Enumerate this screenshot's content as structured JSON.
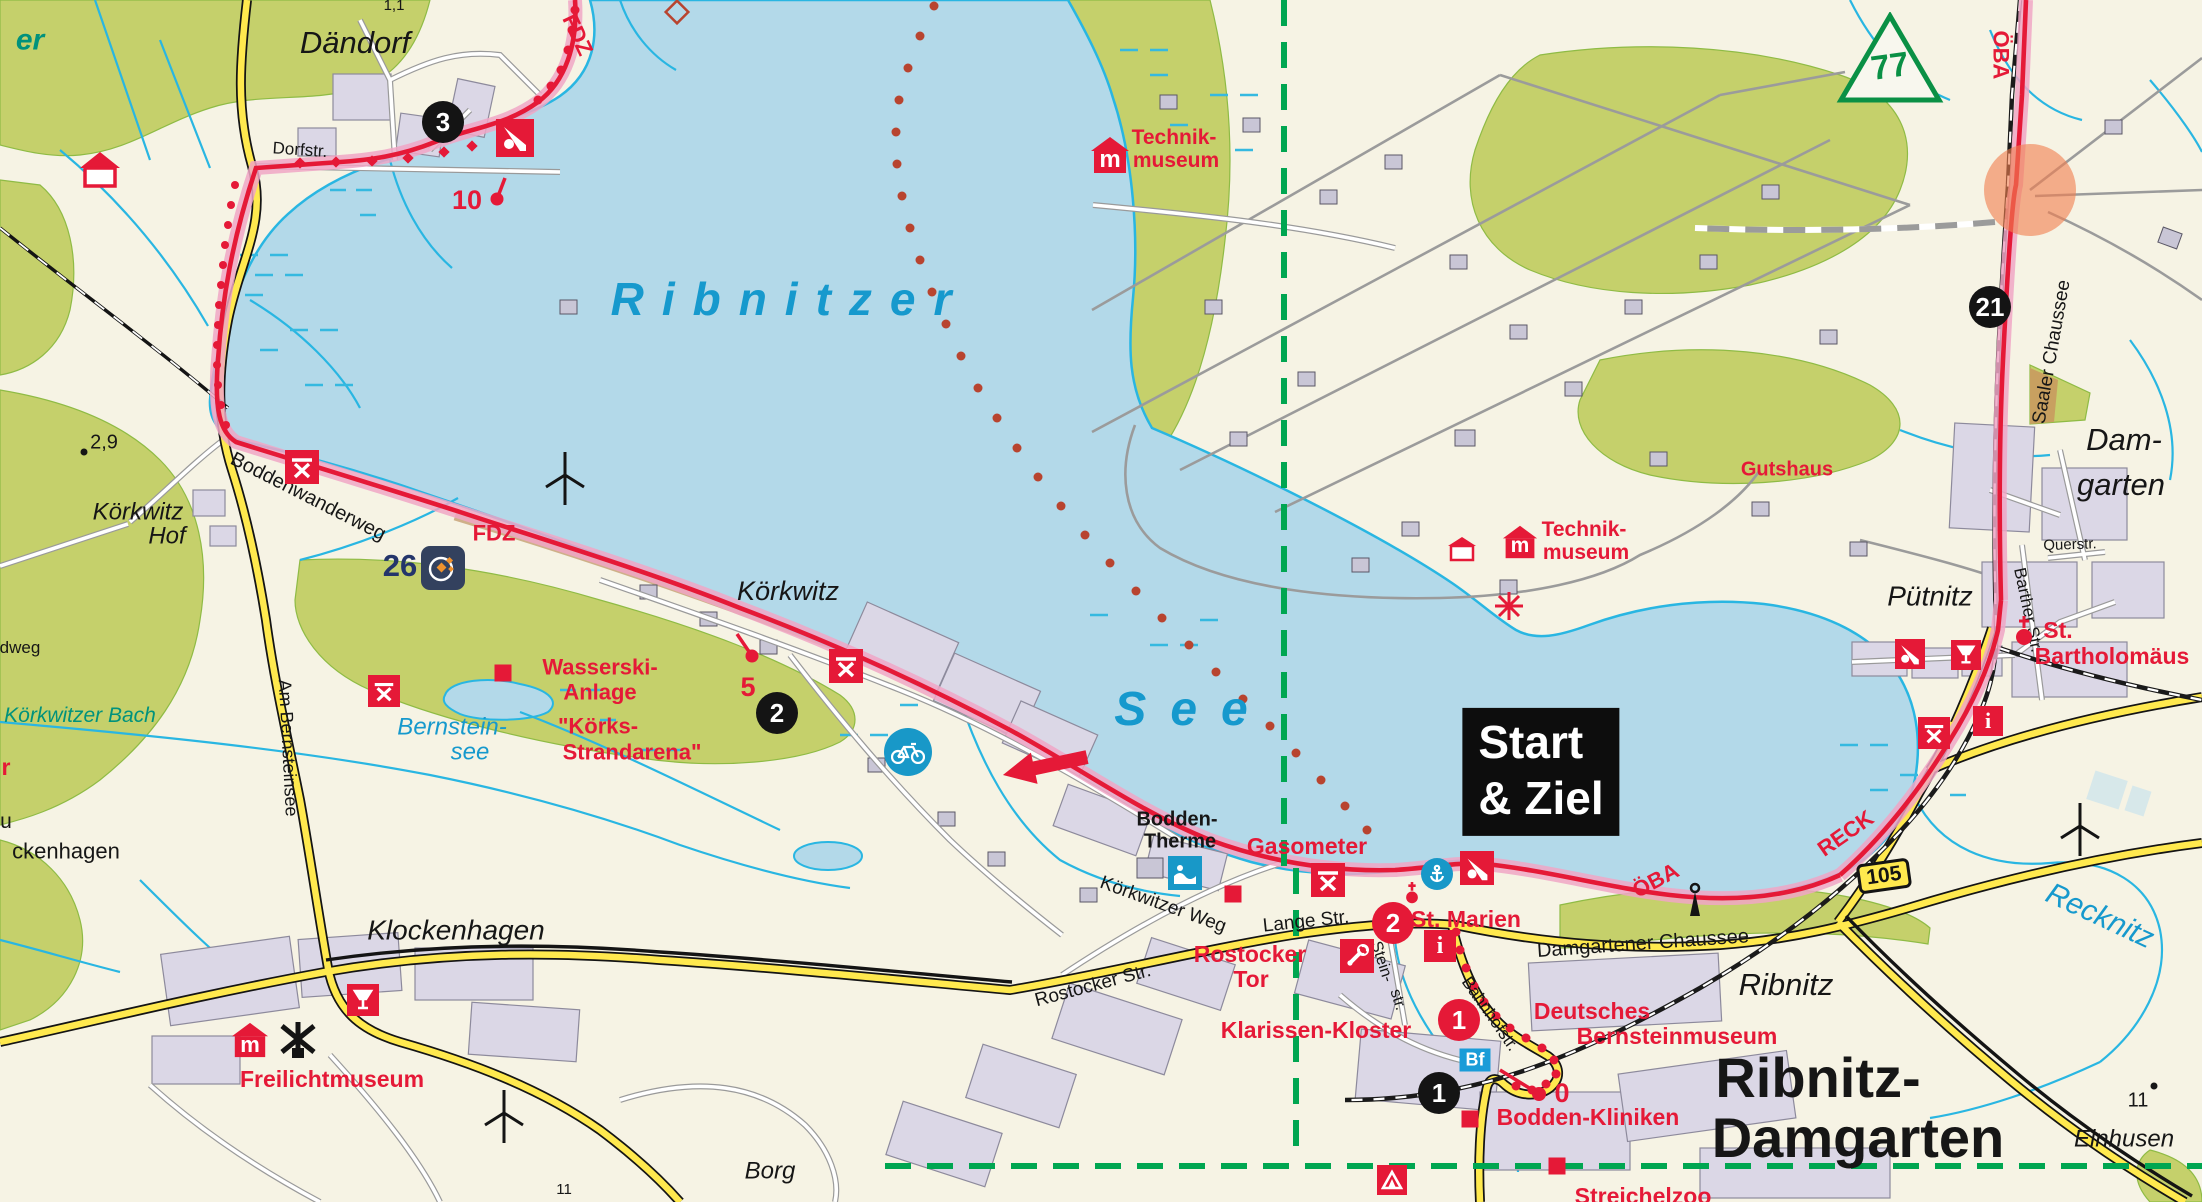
{
  "colors": {
    "land": "#f6f3e4",
    "water": "#b3d9e9",
    "stream": "#29b6e2",
    "forest": "#c5d06b",
    "route_red": "#e51937",
    "route_halo": "#f0a6c6",
    "road_yellow": "#ffe94e",
    "boundary_green": "#00a651",
    "water_label_blue": "#1699cd",
    "rail_black": "#1a1a1a",
    "ferry_dot": "#b8442f"
  },
  "water": {
    "ribnitzer": "Ribnitzer",
    "see": "See",
    "bernstein1": "Bernstein-",
    "bernstein2": "see",
    "recknitz": "Recknitz",
    "bach": "Körkwitzer Bach",
    "partial_er": "er"
  },
  "towns": {
    "daendorf": "Dändorf",
    "hof1": "Körkwitz",
    "hof2": "Hof",
    "koerkwitz": "Körkwitz",
    "klockenhagen": "Klockenhagen",
    "borg": "Borg",
    "puetnitz": "Pütnitz",
    "damgarten1": "Dam-",
    "damgarten2": "garten",
    "ribnitz": "Ribnitz",
    "einhusen": "Einhusen",
    "big1": "Ribnitz-",
    "big2": "Damgarten",
    "partial_u": "u",
    "partial_ckenhagen": "ckenhagen",
    "partial_dweg": "dweg",
    "partial_r": "r"
  },
  "streets": {
    "dorfstr": "Dorfstr.",
    "boddenwanderweg": "Boddenwanderweg",
    "am_bernsteinsee": "Am Bernsteinsee",
    "koerkwitzer_weg": "Körkwitzer Weg",
    "lange_str": "Lange Str.",
    "rostocker_str": "Rostocker Str.",
    "stein1": "Stein-",
    "stein2": "str.",
    "bahnhofstr": "Bahnhofstr.",
    "damgartener_chaussee": "Damgartener Chaussee",
    "saaler_chaussee": "Saaler Chaussee",
    "barther_str": "Barther Str.",
    "querstr": "Querstr."
  },
  "pois": {
    "technikA1": "Technik-",
    "technikA2": "museum",
    "technikB1": "Technik-",
    "technikB2": "museum",
    "gutshaus": "Gutshaus",
    "stbart1": "St.",
    "stbart2": "Bartholomäus",
    "stmarien": "St. Marien",
    "gasometer": "Gasometer",
    "therme1": "Bodden-",
    "therme2": "Therme",
    "rostocker_tor1": "Rostocker",
    "rostocker_tor2": "Tor",
    "klarissen": "Klarissen-Kloster",
    "bernstein1": "Deutsches",
    "bernstein2": "Bernsteinmuseum",
    "kliniken": "Bodden-Kliniken",
    "streichelzoo": "Streichelzoo",
    "freilichtmuseum": "Freilichtmuseum",
    "wasserski1": "Wasserski-",
    "wasserski2": "Anlage",
    "koerks1": "\"Körks-",
    "koerks2": "Strandarena\""
  },
  "route": {
    "fdz_top": "FDZ",
    "fdz_mid": "FDZ",
    "oeba_top": "ÖBA",
    "oeba_bay": "ÖBA",
    "reck": "RECK",
    "start1": "Start",
    "start2": "& Ziel"
  },
  "markers": {
    "m3": "3",
    "m2_black": "2",
    "m1_black": "1",
    "m21": "21",
    "m2_red": "2",
    "m1_red": "1",
    "n10": "10",
    "n5": "5",
    "n0": "0",
    "n26": "26",
    "bf": "Bf",
    "road105": "105",
    "tri77": "77"
  },
  "elevations": {
    "e29": "2,9",
    "e11a": "11",
    "e11b": "11",
    "e11c": "1,1"
  },
  "icons": {
    "museum_glyph": "m",
    "info_glyph": "i"
  }
}
